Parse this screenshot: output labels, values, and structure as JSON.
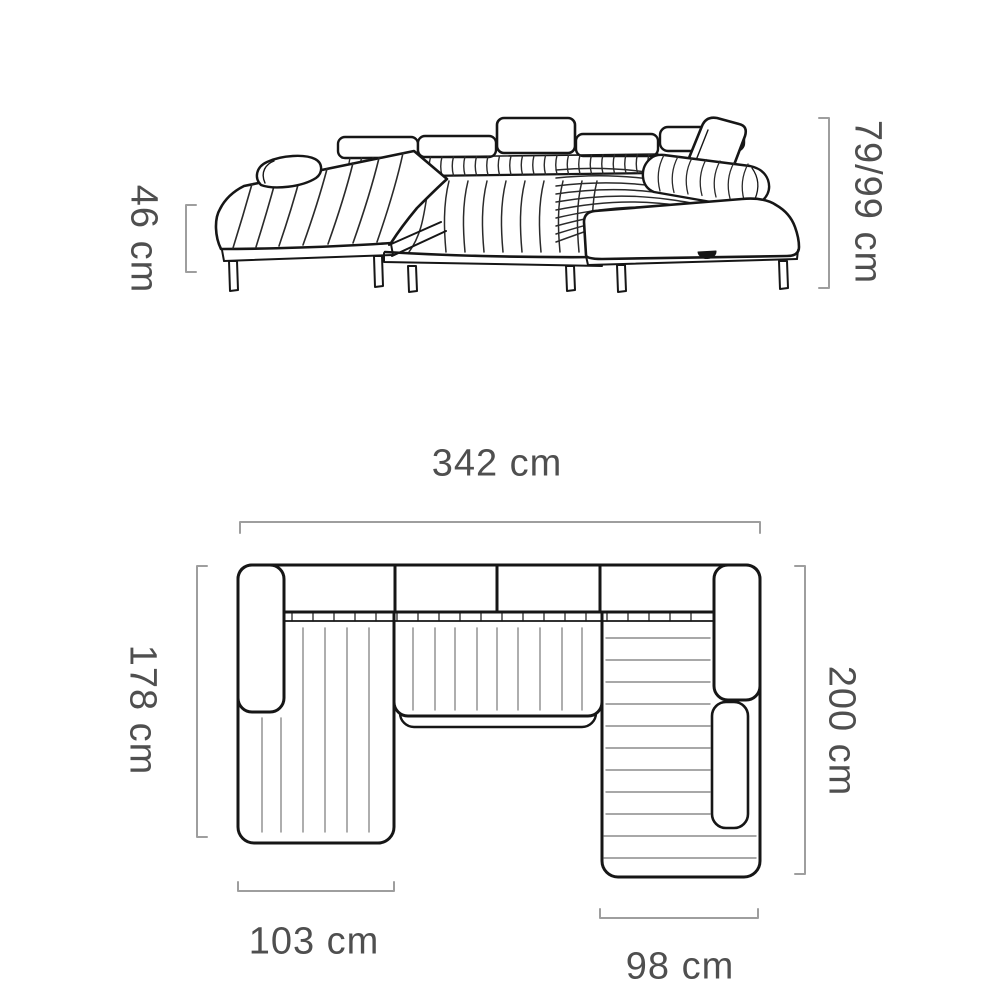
{
  "diagram": {
    "subject": "u-shaped-sectional-sofa-dimension-drawing",
    "views": {
      "front_view": "front elevation of sofa",
      "top_view": "top plan of sofa"
    }
  },
  "dimensions": {
    "front_view": {
      "seat_height": "46 cm",
      "back_height": "79/99 cm"
    },
    "top_view": {
      "total_width": "342 cm",
      "left_depth": "178 cm",
      "right_depth": "200 cm",
      "left_chaise_width": "103 cm",
      "right_chaise_width": "98 cm"
    }
  },
  "colors": {
    "background": "#ffffff",
    "outline": "#161616",
    "stripe": "#2a2a2a",
    "plan_stripe": "#8c8c8c",
    "dimension_line": "#9e9e9e",
    "label_text": "#4f4f4f"
  }
}
